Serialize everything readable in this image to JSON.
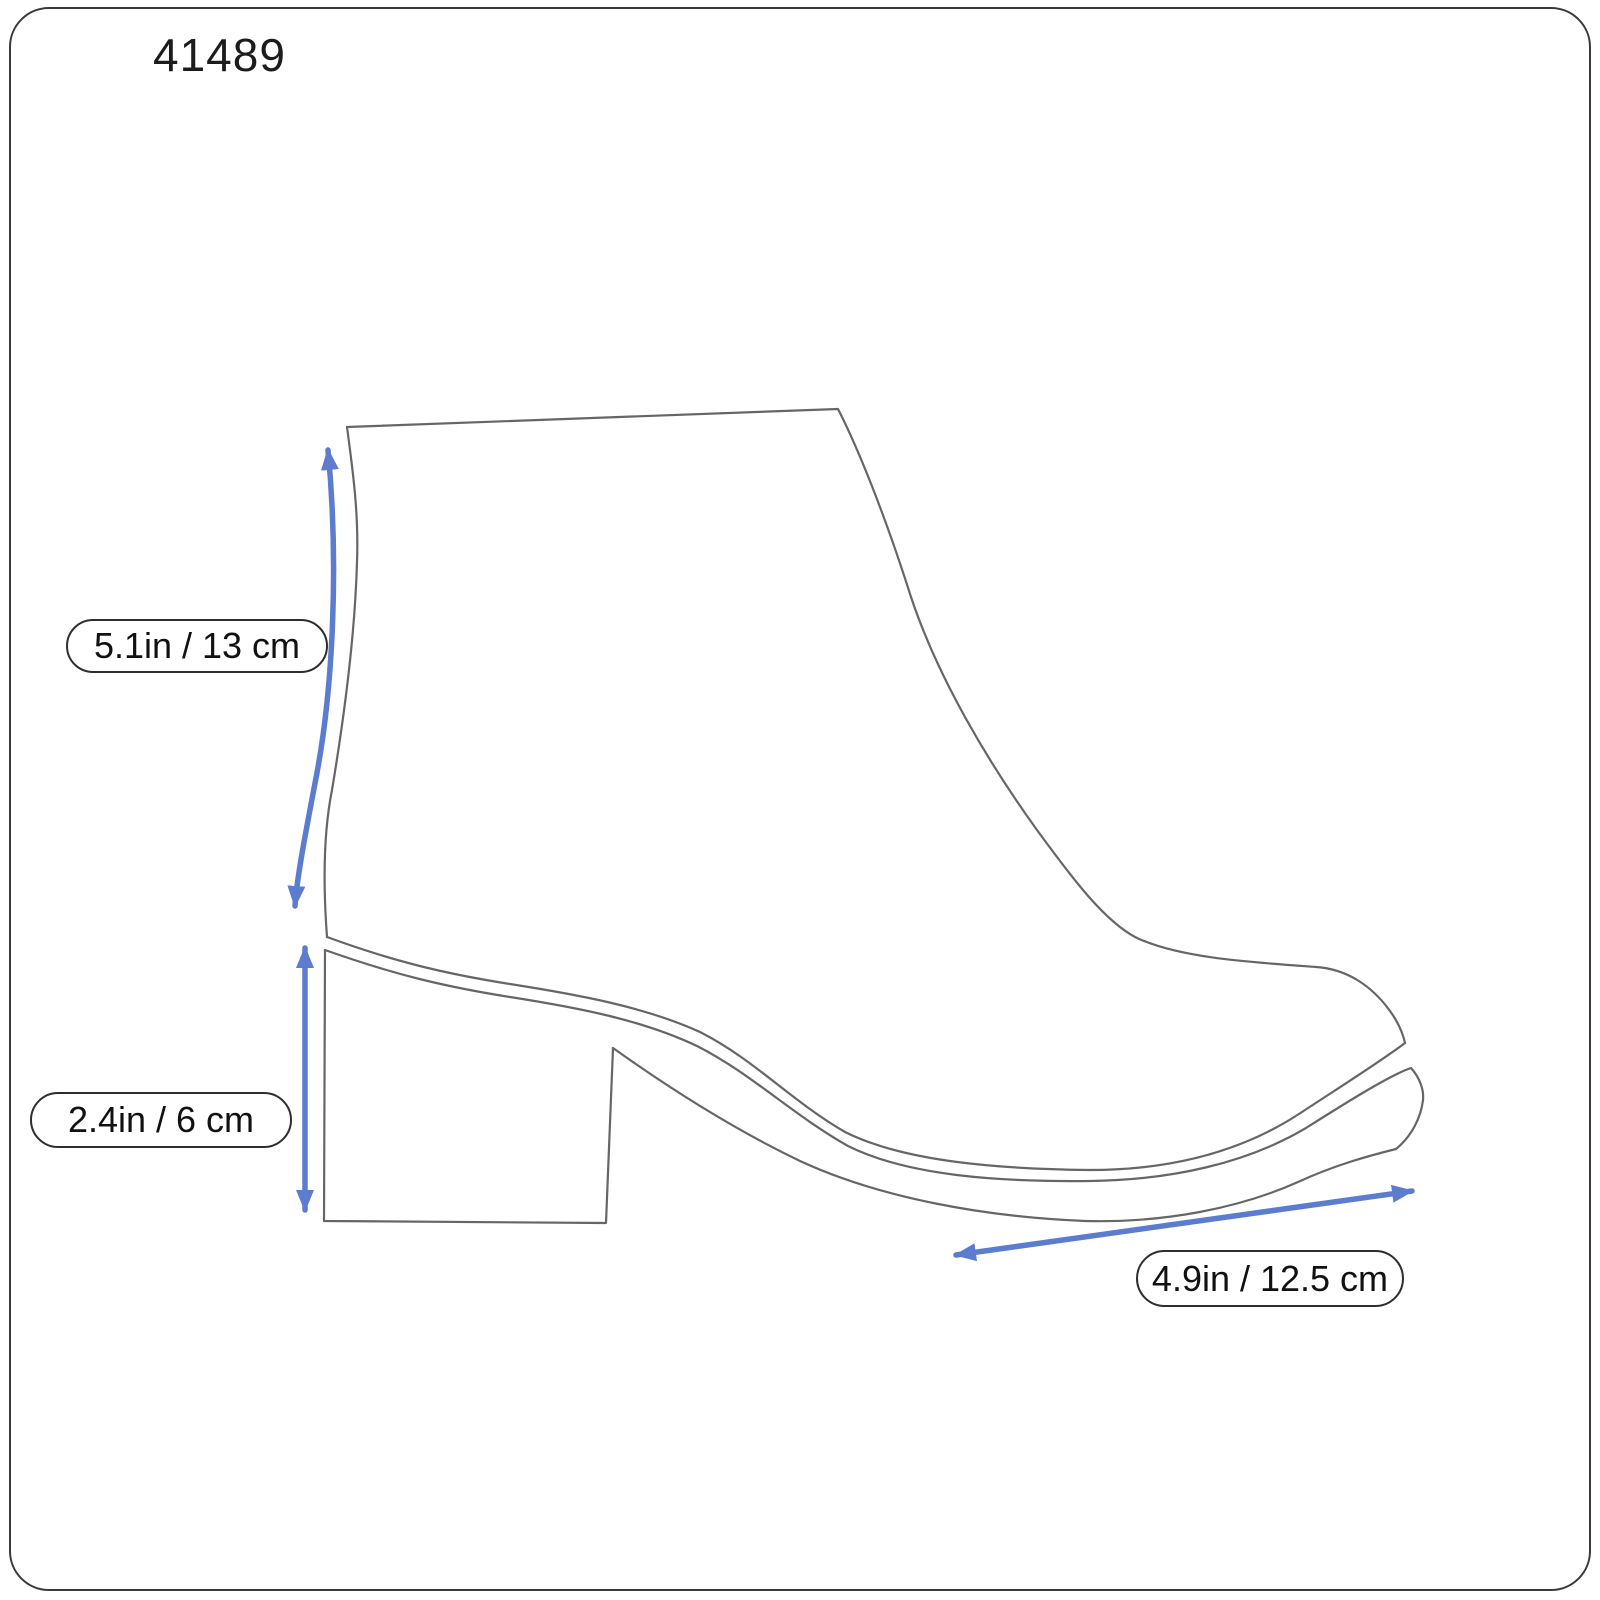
{
  "title": "41489",
  "measurements": {
    "shaft_height": {
      "name": "shaft height",
      "label": "5.1in / 13 cm"
    },
    "heel_height": {
      "name": "heel height",
      "label": "2.4in / 6 cm"
    },
    "sole_length": {
      "name": "sole length",
      "label": "4.9in / 12.5 cm"
    }
  },
  "colors": {
    "arrow_blue": "#5b7ccf",
    "outline_gray": "#666666",
    "border_dark": "#3a3a3a",
    "text_dark": "#1c1c1c"
  }
}
